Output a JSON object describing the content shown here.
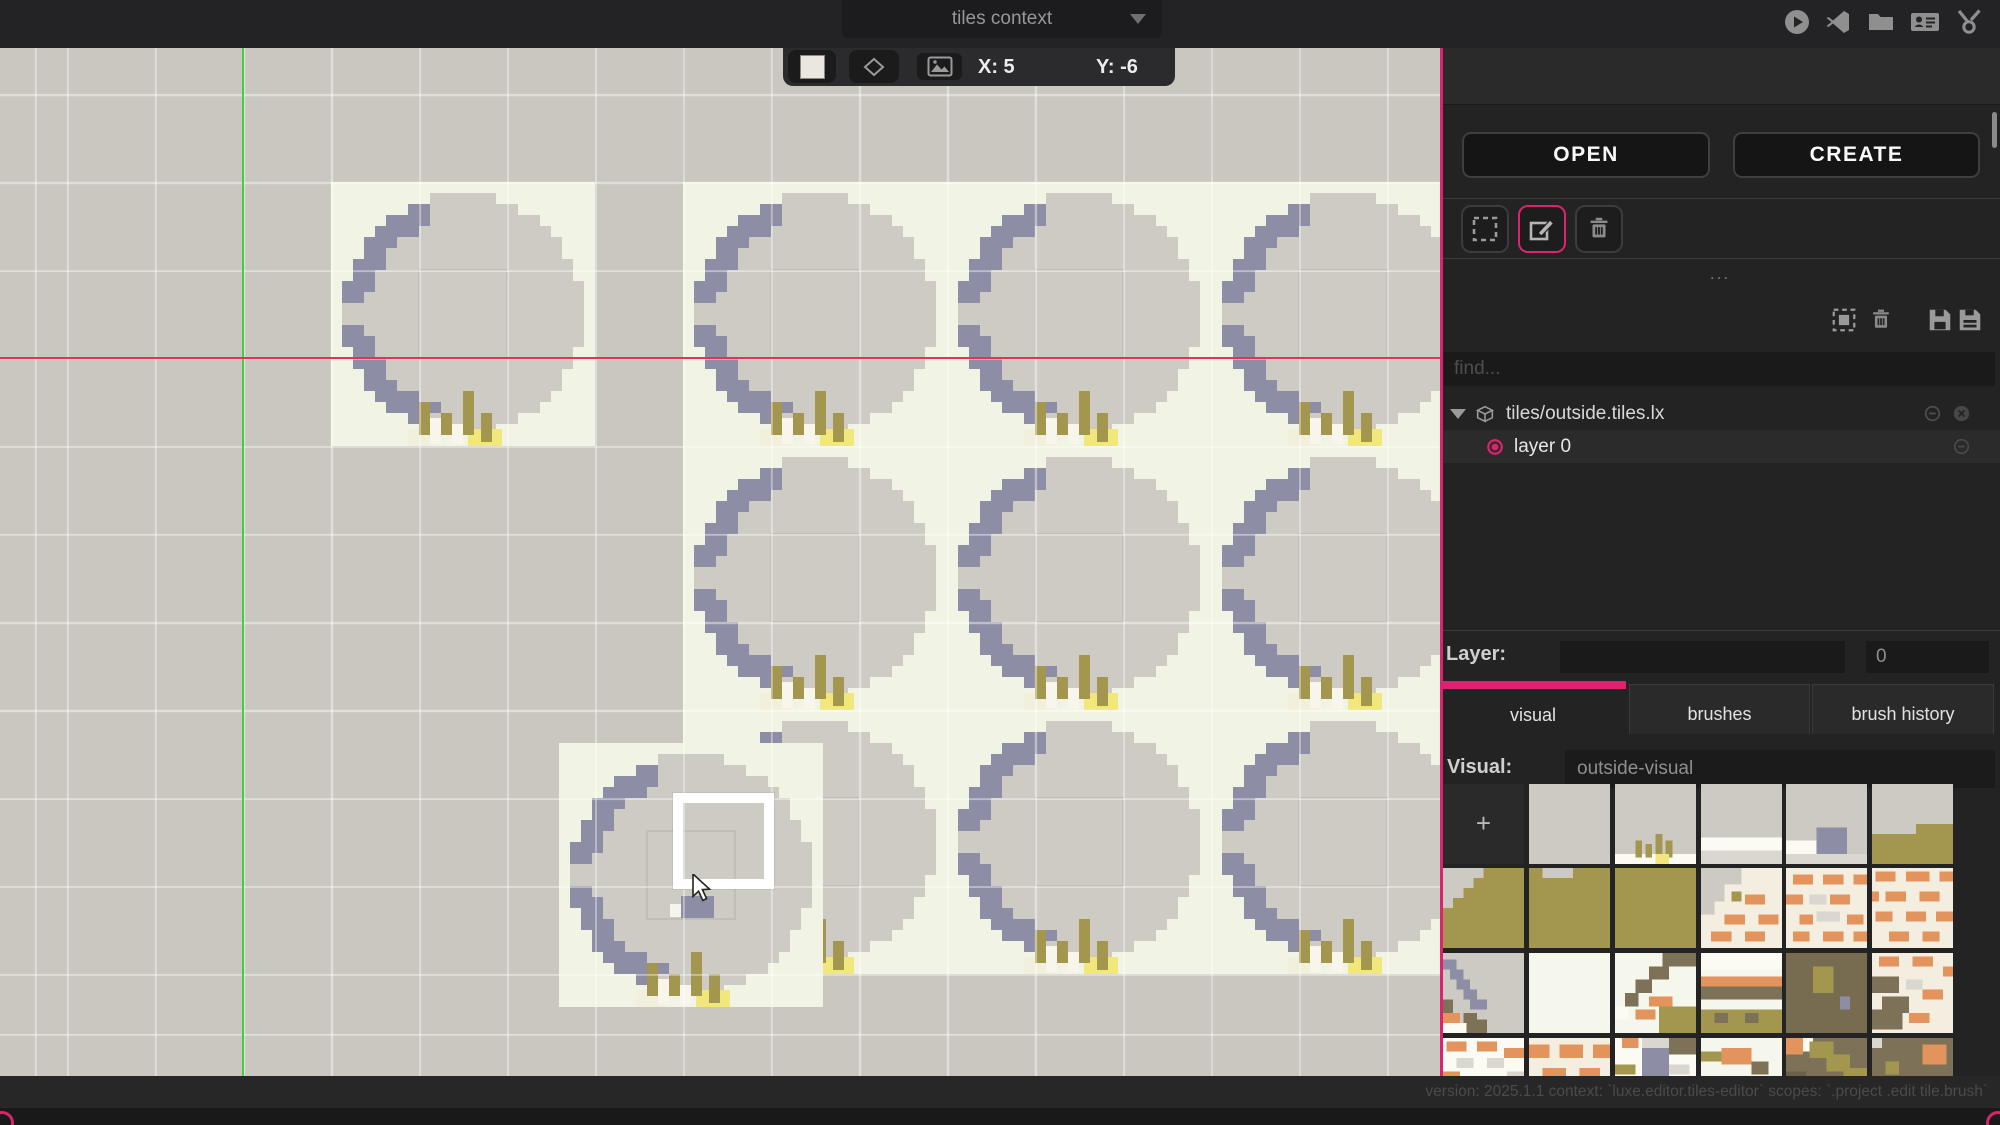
{
  "top_bar": {
    "context_label": "tiles context",
    "icons": [
      "play-icon",
      "vscode-icon",
      "folder-icon",
      "contacts-icon",
      "tools-icon"
    ]
  },
  "canvas_toolbar": {
    "x_coord": "X: 5",
    "y_coord": "Y: -6",
    "swatch_color": "#eae8de",
    "icons": [
      "tile-swatch",
      "diamond-icon",
      "image-icon"
    ]
  },
  "canvas": {
    "bg": "#cac7c1",
    "grid": {
      "size": 88,
      "offset_x": 67,
      "offset_y": 6,
      "color": "rgba(255,255,255,0.42)"
    },
    "axes": {
      "vertical_x": 243,
      "vertical_color": "#3ed13e",
      "horizontal_y": 358,
      "horizontal_color": "#f02d55"
    },
    "tile_size": 264,
    "tile_colors": {
      "bg": "#f1f4e4",
      "base": "#cecbc5",
      "shadow": "#8d8da5",
      "grass": "#a3974f",
      "white": "#f8f6ec",
      "sand": "#f2e77d",
      "sand_pale": "#f2efdc"
    },
    "tiles": [
      [
        331,
        182
      ],
      [
        683,
        182
      ],
      [
        947,
        182
      ],
      [
        1211,
        182
      ],
      [
        683,
        446
      ],
      [
        947,
        446
      ],
      [
        1211,
        446
      ],
      [
        683,
        710
      ],
      [
        947,
        710
      ],
      [
        1211,
        710
      ],
      [
        559,
        743
      ]
    ],
    "painted_pixels": [
      [
        681,
        896,
        33,
        22,
        "#8d8da5"
      ],
      [
        670,
        904,
        11,
        13,
        "#f6f5ec"
      ]
    ],
    "brush_cursor": {
      "x": 673,
      "y": 793,
      "w": 101,
      "h": 96
    },
    "pointer": {
      "x": 691,
      "y": 874
    }
  },
  "sidebar": {
    "accent": "#dd2370",
    "open_label": "OPEN",
    "create_label": "CREATE",
    "tools": [
      "marquee-select-icon",
      "edit-icon",
      "trash-icon"
    ],
    "more_label": "...",
    "list_icons": [
      "select-all-icon",
      "trash-icon",
      "save-icon",
      "save-as-icon"
    ],
    "find_placeholder": "find...",
    "tree": {
      "file_label": "tiles/outside.tiles.lx",
      "layers": [
        {
          "label": "layer 0",
          "selected": true
        }
      ]
    },
    "layer_label": "Layer:",
    "layer_value": "0",
    "tabs": [
      {
        "label": "visual",
        "active": true
      },
      {
        "label": "brushes",
        "active": false
      },
      {
        "label": "brush history",
        "active": false
      }
    ],
    "visual_label": "Visual:",
    "visual_value": "outside-visual",
    "palette": {
      "add_label": "+",
      "columns": 6,
      "col_x": [
        3,
        89,
        175,
        261,
        346,
        432
      ],
      "row_y": [
        736,
        820,
        905,
        990
      ],
      "tiles": [
        {
          "bg": "#cdcac4",
          "px": []
        },
        {
          "bg": "#cdcac4",
          "px": [
            [
              0,
              21,
              24,
              3,
              "#fbfaf3"
            ],
            [
              6,
              17,
              2,
              5,
              "#a3974f"
            ],
            [
              9,
              18,
              2,
              4,
              "#a3974f"
            ],
            [
              12,
              15,
              2,
              7,
              "#a3974f"
            ],
            [
              15,
              17,
              2,
              5,
              "#a3974f"
            ],
            [
              12,
              21,
              4,
              3,
              "#f2e77d"
            ]
          ]
        },
        {
          "bg": "#cdcac4",
          "px": [
            [
              0,
              16,
              24,
              4,
              "#fbfaf3"
            ],
            [
              0,
              20,
              24,
              4,
              "#dad7d1"
            ]
          ]
        },
        {
          "bg": "#cdcac4",
          "px": [
            [
              0,
              17,
              9,
              4,
              "#fbfaf3"
            ],
            [
              9,
              13,
              9,
              8,
              "#8d8da5"
            ],
            [
              0,
              21,
              24,
              3,
              "#dad7d1"
            ]
          ]
        },
        {
          "bg": "#cdcac4",
          "px": [
            [
              0,
              15,
              24,
              9,
              "#a3974f"
            ],
            [
              13,
              12,
              11,
              3,
              "#a3974f"
            ]
          ]
        },
        {
          "bg": "#a3974f",
          "px": [
            [
              0,
              0,
              3,
              12,
              "#cdcac4"
            ],
            [
              3,
              0,
              3,
              9,
              "#cdcac4"
            ],
            [
              6,
              0,
              3,
              6,
              "#cdcac4"
            ],
            [
              9,
              0,
              3,
              3,
              "#cdcac4"
            ]
          ]
        },
        {
          "bg": "#a3974f",
          "px": [
            [
              4,
              0,
              9,
              3,
              "#cdcac4"
            ]
          ]
        },
        {
          "bg": "#a3974f",
          "px": []
        },
        {
          "bg": "#f3eee0",
          "px": [
            [
              0,
              0,
              12,
              5,
              "#cdcac4"
            ],
            [
              0,
              5,
              7,
              5,
              "#cdcac4"
            ],
            [
              0,
              10,
              4,
              4,
              "#cdcac4"
            ],
            [
              9,
              7,
              3,
              3,
              "#a3974f"
            ],
            [
              13,
              8,
              6,
              3,
              "#e3935c"
            ],
            [
              7,
              14,
              6,
              3,
              "#e3935c"
            ],
            [
              17,
              14,
              6,
              3,
              "#e3935c"
            ],
            [
              3,
              19,
              6,
              3,
              "#e3935c"
            ],
            [
              13,
              19,
              6,
              3,
              "#e3935c"
            ]
          ]
        },
        {
          "bg": "#f3eee0",
          "px": [
            [
              2,
              2,
              6,
              3,
              "#e3935c"
            ],
            [
              11,
              2,
              6,
              3,
              "#e3935c"
            ],
            [
              20,
              2,
              4,
              3,
              "#e3935c"
            ],
            [
              0,
              8,
              5,
              3,
              "#e3935c"
            ],
            [
              13,
              8,
              6,
              3,
              "#e3935c"
            ],
            [
              7,
              8,
              5,
              3,
              "#dad7d1"
            ],
            [
              9,
              13,
              7,
              3,
              "#dad7d1"
            ],
            [
              4,
              14,
              4,
              3,
              "#e3935c"
            ],
            [
              18,
              14,
              5,
              3,
              "#e3935c"
            ],
            [
              2,
              19,
              5,
              3,
              "#e3935c"
            ],
            [
              11,
              19,
              6,
              3,
              "#e3935c"
            ],
            [
              20,
              19,
              4,
              3,
              "#e3935c"
            ]
          ]
        },
        {
          "bg": "#f3eee0",
          "px": [
            [
              1,
              1,
              6,
              3,
              "#e3935c"
            ],
            [
              10,
              1,
              7,
              3,
              "#e3935c"
            ],
            [
              20,
              1,
              4,
              3,
              "#e3935c"
            ],
            [
              0,
              7,
              2,
              3,
              "#e3935c"
            ],
            [
              4,
              7,
              6,
              3,
              "#e3935c"
            ],
            [
              14,
              7,
              6,
              3,
              "#e3935c"
            ],
            [
              1,
              13,
              5,
              3,
              "#e3935c"
            ],
            [
              10,
              13,
              6,
              3,
              "#e3935c"
            ],
            [
              19,
              13,
              5,
              3,
              "#e3935c"
            ],
            [
              5,
              19,
              6,
              3,
              "#e3935c"
            ],
            [
              15,
              19,
              5,
              3,
              "#e3935c"
            ]
          ]
        },
        {
          "bg": "#cdcac4",
          "px": [
            [
              0,
              2,
              4,
              3,
              "#8d8da5"
            ],
            [
              2,
              5,
              4,
              3,
              "#8d8da5"
            ],
            [
              4,
              8,
              4,
              3,
              "#8d8da5"
            ],
            [
              6,
              11,
              4,
              3,
              "#8d8da5"
            ],
            [
              8,
              14,
              5,
              3,
              "#8d8da5"
            ],
            [
              0,
              14,
              3,
              4,
              "#7d7257"
            ],
            [
              0,
              18,
              5,
              3,
              "#e3935c"
            ],
            [
              6,
              18,
              4,
              3,
              "#7d7257"
            ],
            [
              0,
              21,
              7,
              3,
              "#fbfaf3"
            ],
            [
              7,
              20,
              6,
              4,
              "#7d7257"
            ]
          ]
        },
        {
          "bg": "#f5f7ec",
          "px": []
        },
        {
          "bg": "#f5f7ec",
          "px": [
            [
              14,
              0,
              10,
              4,
              "#7d7257"
            ],
            [
              10,
              4,
              6,
              4,
              "#7d7257"
            ],
            [
              6,
              8,
              5,
              4,
              "#7d7257"
            ],
            [
              3,
              12,
              4,
              4,
              "#7d7257"
            ],
            [
              10,
              13,
              7,
              3,
              "#e3935c"
            ],
            [
              6,
              17,
              6,
              3,
              "#e3935c"
            ],
            [
              13,
              16,
              11,
              8,
              "#a3974f"
            ],
            [
              0,
              16,
              4,
              4,
              "#fbfaf3"
            ]
          ]
        },
        {
          "bg": "#f5f7ec",
          "px": [
            [
              0,
              0,
              24,
              5,
              "#fbfaf3"
            ],
            [
              0,
              7,
              24,
              3,
              "#e3935c"
            ],
            [
              0,
              10,
              24,
              4,
              "#7d7257"
            ],
            [
              0,
              17,
              24,
              7,
              "#a3974f"
            ],
            [
              4,
              18,
              4,
              3,
              "#7d7257"
            ],
            [
              13,
              18,
              4,
              3,
              "#7d7257"
            ]
          ]
        },
        {
          "bg": "#776b50",
          "px": [
            [
              8,
              4,
              6,
              8,
              "#a3974f"
            ],
            [
              16,
              13,
              3,
              4,
              "#8d8da5"
            ]
          ]
        },
        {
          "bg": "#f3eee0",
          "px": [
            [
              2,
              1,
              6,
              3,
              "#e3935c"
            ],
            [
              12,
              1,
              6,
              3,
              "#e3935c"
            ],
            [
              21,
              4,
              3,
              3,
              "#e3935c"
            ],
            [
              0,
              7,
              8,
              5,
              "#7d7257"
            ],
            [
              10,
              8,
              5,
              3,
              "#dad7d1"
            ],
            [
              15,
              11,
              6,
              3,
              "#e3935c"
            ],
            [
              3,
              13,
              8,
              5,
              "#7d7257"
            ],
            [
              0,
              17,
              9,
              6,
              "#7d7257"
            ],
            [
              11,
              18,
              6,
              3,
              "#e3935c"
            ]
          ]
        },
        {
          "bg": "#fbfaf3",
          "px": [
            [
              1,
              1,
              6,
              3,
              "#e3935c"
            ],
            [
              10,
              1,
              6,
              3,
              "#e3935c"
            ],
            [
              18,
              3,
              6,
              3,
              "#e3935c"
            ],
            [
              4,
              6,
              5,
              3,
              "#dad7d1"
            ],
            [
              13,
              6,
              5,
              3,
              "#dad7d1"
            ],
            [
              0,
              10,
              5,
              3,
              "#e3935c"
            ],
            [
              19,
              10,
              5,
              3,
              "#dad7d1"
            ]
          ]
        },
        {
          "bg": "#f3eee0",
          "px": [
            [
              0,
              2,
              6,
              4,
              "#e3935c"
            ],
            [
              9,
              2,
              7,
              4,
              "#e3935c"
            ],
            [
              19,
              2,
              5,
              4,
              "#e3935c"
            ],
            [
              4,
              9,
              7,
              4,
              "#e3935c"
            ],
            [
              15,
              9,
              6,
              4,
              "#e3935c"
            ]
          ]
        },
        {
          "bg": "#fbfaf3",
          "px": [
            [
              2,
              0,
              5,
              3,
              "#e3935c"
            ],
            [
              8,
              0,
              8,
              3,
              "#dad7d1"
            ],
            [
              8,
              3,
              8,
              10,
              "#8d8da5"
            ],
            [
              16,
              0,
              8,
              5,
              "#7d7257"
            ],
            [
              0,
              8,
              6,
              3,
              "#a3974f"
            ],
            [
              16,
              8,
              6,
              3,
              "#dad7d1"
            ]
          ]
        },
        {
          "bg": "#f5f7ec",
          "px": [
            [
              0,
              4,
              6,
              3,
              "#a3974f"
            ],
            [
              6,
              3,
              9,
              5,
              "#e3935c"
            ],
            [
              15,
              7,
              5,
              4,
              "#7d7257"
            ]
          ]
        },
        {
          "bg": "#7d7257",
          "px": [
            [
              0,
              0,
              5,
              5,
              "#e3935c"
            ],
            [
              5,
              0,
              3,
              4,
              "#fbfaf3"
            ],
            [
              7,
              1,
              7,
              5,
              "#a3974f"
            ],
            [
              12,
              5,
              7,
              5,
              "#a3974f"
            ],
            [
              17,
              9,
              7,
              5,
              "#a3974f"
            ],
            [
              0,
              10,
              6,
              6,
              "#6a614b"
            ]
          ]
        },
        {
          "bg": "#7d7257",
          "px": [
            [
              0,
              0,
              3,
              3,
              "#dad7d1"
            ],
            [
              15,
              2,
              7,
              6,
              "#e3935c"
            ],
            [
              4,
              7,
              4,
              4,
              "#a3974f"
            ]
          ]
        }
      ]
    }
  },
  "status_bar": {
    "text": "version: 2025.1.1 context: `luxe.editor.tiles-editor` scopes: `.project .edit tile.brush`"
  }
}
